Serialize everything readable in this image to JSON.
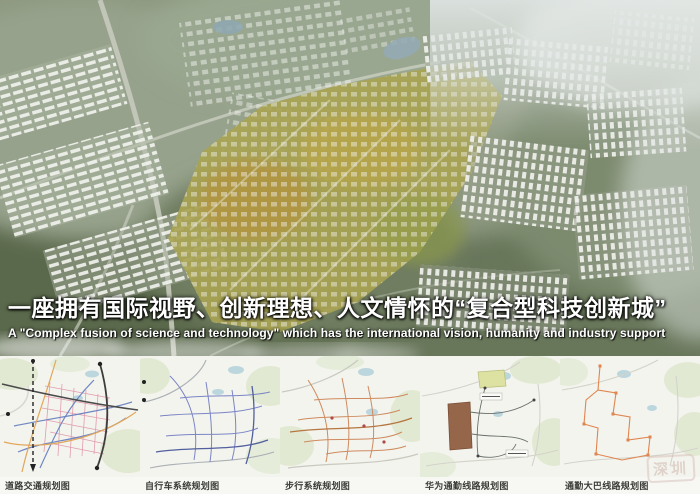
{
  "board": {
    "title_cn": "一座拥有国际视野、创新理想、人文情怀的“复合型科技创新城”",
    "title_en": "A \"Complex fusion of science and technology\" which has the international vision, humanity and industry support"
  },
  "maps": [
    {
      "caption": "道路交通规划图"
    },
    {
      "caption": "自行车系统规划图"
    },
    {
      "caption": "步行系统规划图"
    },
    {
      "caption": "华为通勤线路规划图"
    },
    {
      "caption": "通勤大巴线路规划图"
    }
  ],
  "watermark": "深圳",
  "colors": {
    "terrain_green": "#8d987f",
    "campus_yellow": "#a8a352",
    "mist_white": "#ffffff",
    "map_background": "#f3f4ee",
    "road_traffic_accent": "#e093a8",
    "bicycle_accent": "#7b85c5",
    "pedestrian_accent": "#cf8a5e",
    "huawei_campus_brown": "#96664a",
    "bus_route_orange": "#e0854f"
  }
}
